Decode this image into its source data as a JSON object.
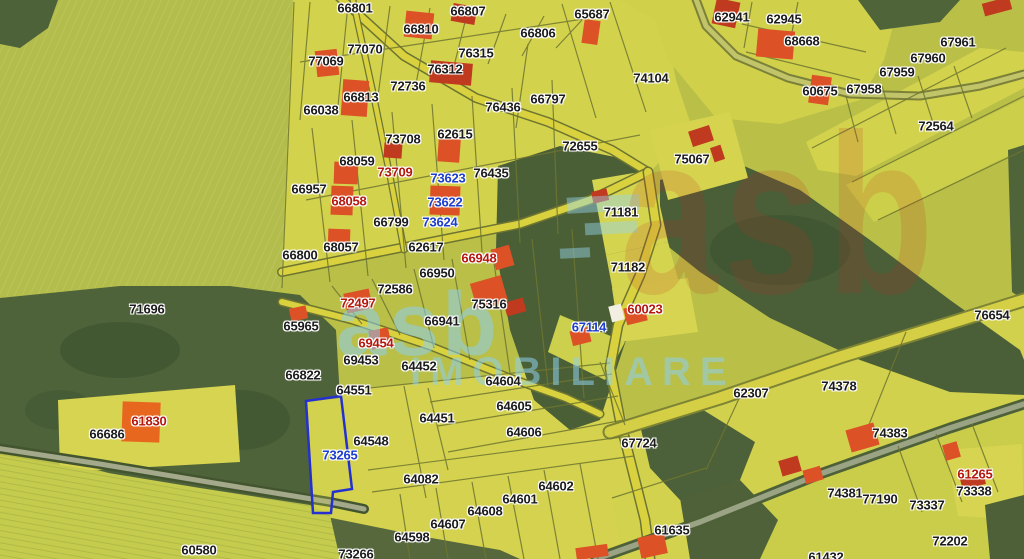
{
  "map": {
    "type": "cadastral-parcel-map",
    "selected_parcel": "73265",
    "watermark": {
      "brand": "asb",
      "word": "IMOBILIARE"
    },
    "colors": {
      "label_black": "#1b1b1b",
      "label_red": "#b5170e",
      "label_blue": "#1d3dcc",
      "selected_outline": "#2431d0",
      "watermark_blue": "rgba(142,208,236,0.55)",
      "watermark_red": "rgba(190,45,28,0.16)",
      "buildings": [
        "#dc5126",
        "#bf3a1f",
        "#e8671f",
        "#f2efe2"
      ]
    },
    "parcels": [
      {
        "id": "66801",
        "x": 355,
        "y": 8
      },
      {
        "id": "66807",
        "x": 468,
        "y": 11
      },
      {
        "id": "65687",
        "x": 592,
        "y": 14
      },
      {
        "id": "62941",
        "x": 732,
        "y": 17
      },
      {
        "id": "62945",
        "x": 784,
        "y": 19
      },
      {
        "id": "66810",
        "x": 421,
        "y": 29
      },
      {
        "id": "66806",
        "x": 538,
        "y": 33
      },
      {
        "id": "67961",
        "x": 958,
        "y": 42
      },
      {
        "id": "68668",
        "x": 802,
        "y": 41
      },
      {
        "id": "77070",
        "x": 365,
        "y": 49
      },
      {
        "id": "76315",
        "x": 476,
        "y": 53
      },
      {
        "id": "67960",
        "x": 928,
        "y": 58
      },
      {
        "id": "77069",
        "x": 326,
        "y": 61
      },
      {
        "id": "76312",
        "x": 445,
        "y": 69
      },
      {
        "id": "67959",
        "x": 897,
        "y": 72
      },
      {
        "id": "74104",
        "x": 651,
        "y": 78
      },
      {
        "id": "72736",
        "x": 408,
        "y": 86
      },
      {
        "id": "67958",
        "x": 864,
        "y": 89
      },
      {
        "id": "60675",
        "x": 820,
        "y": 91
      },
      {
        "id": "66813",
        "x": 361,
        "y": 97
      },
      {
        "id": "66797",
        "x": 548,
        "y": 99
      },
      {
        "id": "76436",
        "x": 503,
        "y": 107
      },
      {
        "id": "66038",
        "x": 321,
        "y": 110
      },
      {
        "id": "72564",
        "x": 936,
        "y": 126
      },
      {
        "id": "62615",
        "x": 455,
        "y": 134
      },
      {
        "id": "73708",
        "x": 403,
        "y": 139
      },
      {
        "id": "72655",
        "x": 580,
        "y": 146
      },
      {
        "id": "68059",
        "x": 357,
        "y": 161
      },
      {
        "id": "75067",
        "x": 692,
        "y": 159
      },
      {
        "id": "73709",
        "x": 395,
        "y": 172,
        "c": "r"
      },
      {
        "id": "76435",
        "x": 491,
        "y": 173
      },
      {
        "id": "73623",
        "x": 448,
        "y": 178,
        "c": "b"
      },
      {
        "id": "66957",
        "x": 309,
        "y": 189
      },
      {
        "id": "68058",
        "x": 349,
        "y": 201,
        "c": "r"
      },
      {
        "id": "73622",
        "x": 445,
        "y": 202,
        "c": "b"
      },
      {
        "id": "71181",
        "x": 621,
        "y": 212
      },
      {
        "id": "73624",
        "x": 440,
        "y": 222,
        "c": "b"
      },
      {
        "id": "66799",
        "x": 391,
        "y": 222
      },
      {
        "id": "68057",
        "x": 341,
        "y": 247
      },
      {
        "id": "62617",
        "x": 426,
        "y": 247
      },
      {
        "id": "66800",
        "x": 300,
        "y": 255
      },
      {
        "id": "66948",
        "x": 479,
        "y": 258,
        "c": "r"
      },
      {
        "id": "71182",
        "x": 628,
        "y": 267
      },
      {
        "id": "66950",
        "x": 437,
        "y": 273
      },
      {
        "id": "72586",
        "x": 395,
        "y": 289
      },
      {
        "id": "72497",
        "x": 358,
        "y": 303,
        "c": "r"
      },
      {
        "id": "75316",
        "x": 489,
        "y": 304
      },
      {
        "id": "71696",
        "x": 147,
        "y": 309
      },
      {
        "id": "60023",
        "x": 645,
        "y": 309,
        "c": "r"
      },
      {
        "id": "76654",
        "x": 992,
        "y": 315
      },
      {
        "id": "66941",
        "x": 442,
        "y": 321
      },
      {
        "id": "65965",
        "x": 301,
        "y": 326
      },
      {
        "id": "67114",
        "x": 589,
        "y": 327,
        "c": "b"
      },
      {
        "id": "69454",
        "x": 376,
        "y": 343,
        "c": "r"
      },
      {
        "id": "69453",
        "x": 361,
        "y": 360
      },
      {
        "id": "64452",
        "x": 419,
        "y": 366
      },
      {
        "id": "66822",
        "x": 303,
        "y": 375
      },
      {
        "id": "64604",
        "x": 503,
        "y": 381
      },
      {
        "id": "74378",
        "x": 839,
        "y": 386
      },
      {
        "id": "64551",
        "x": 354,
        "y": 390
      },
      {
        "id": "62307",
        "x": 751,
        "y": 393
      },
      {
        "id": "64605",
        "x": 514,
        "y": 406
      },
      {
        "id": "64451",
        "x": 437,
        "y": 418
      },
      {
        "id": "61830",
        "x": 149,
        "y": 421,
        "c": "r"
      },
      {
        "id": "64606",
        "x": 524,
        "y": 432
      },
      {
        "id": "66686",
        "x": 107,
        "y": 434
      },
      {
        "id": "74383",
        "x": 890,
        "y": 433
      },
      {
        "id": "64548",
        "x": 371,
        "y": 441
      },
      {
        "id": "67724",
        "x": 639,
        "y": 443
      },
      {
        "id": "73265",
        "x": 340,
        "y": 455,
        "c": "b"
      },
      {
        "id": "61265",
        "x": 975,
        "y": 474,
        "c": "r"
      },
      {
        "id": "64082",
        "x": 421,
        "y": 479
      },
      {
        "id": "64602",
        "x": 556,
        "y": 486
      },
      {
        "id": "73338",
        "x": 974,
        "y": 491
      },
      {
        "id": "74381",
        "x": 845,
        "y": 493
      },
      {
        "id": "64601",
        "x": 520,
        "y": 499
      },
      {
        "id": "77190",
        "x": 880,
        "y": 499
      },
      {
        "id": "73337",
        "x": 927,
        "y": 505
      },
      {
        "id": "64608",
        "x": 485,
        "y": 511
      },
      {
        "id": "64607",
        "x": 448,
        "y": 524
      },
      {
        "id": "61635",
        "x": 672,
        "y": 530
      },
      {
        "id": "64598",
        "x": 412,
        "y": 537
      },
      {
        "id": "72202",
        "x": 950,
        "y": 541
      },
      {
        "id": "60580",
        "x": 199,
        "y": 550
      },
      {
        "id": "73266",
        "x": 356,
        "y": 554
      },
      {
        "id": "61432",
        "x": 826,
        "y": 557
      }
    ],
    "buildings": [
      {
        "x": 405,
        "y": 12,
        "w": 28,
        "h": 26,
        "a": 6
      },
      {
        "x": 452,
        "y": 5,
        "w": 24,
        "h": 18,
        "a": 10,
        "f": 1
      },
      {
        "x": 583,
        "y": 20,
        "w": 16,
        "h": 24,
        "a": 8
      },
      {
        "x": 316,
        "y": 50,
        "w": 22,
        "h": 26,
        "a": -6
      },
      {
        "x": 714,
        "y": 0,
        "w": 24,
        "h": 26,
        "a": 12,
        "f": 1
      },
      {
        "x": 757,
        "y": 30,
        "w": 37,
        "h": 28,
        "a": 5
      },
      {
        "x": 810,
        "y": 76,
        "w": 20,
        "h": 28,
        "a": 8
      },
      {
        "x": 342,
        "y": 80,
        "w": 26,
        "h": 36,
        "a": 4
      },
      {
        "x": 430,
        "y": 62,
        "w": 42,
        "h": 22,
        "a": 5,
        "f": 1
      },
      {
        "x": 384,
        "y": 143,
        "w": 18,
        "h": 15,
        "a": 4,
        "f": 1
      },
      {
        "x": 438,
        "y": 139,
        "w": 22,
        "h": 23,
        "a": 4
      },
      {
        "x": 334,
        "y": 162,
        "w": 24,
        "h": 22,
        "a": 2
      },
      {
        "x": 331,
        "y": 186,
        "w": 22,
        "h": 29,
        "a": 2
      },
      {
        "x": 430,
        "y": 186,
        "w": 30,
        "h": 29,
        "a": 2
      },
      {
        "x": 328,
        "y": 229,
        "w": 22,
        "h": 23,
        "a": 2
      },
      {
        "x": 690,
        "y": 128,
        "w": 22,
        "h": 16,
        "a": -18,
        "f": 1
      },
      {
        "x": 712,
        "y": 146,
        "w": 11,
        "h": 15,
        "a": -18,
        "f": 1
      },
      {
        "x": 345,
        "y": 291,
        "w": 26,
        "h": 20,
        "a": -12
      },
      {
        "x": 290,
        "y": 307,
        "w": 17,
        "h": 13,
        "a": -12
      },
      {
        "x": 370,
        "y": 329,
        "w": 20,
        "h": 19,
        "a": -12
      },
      {
        "x": 493,
        "y": 247,
        "w": 19,
        "h": 21,
        "a": -16
      },
      {
        "x": 473,
        "y": 279,
        "w": 32,
        "h": 27,
        "a": -16
      },
      {
        "x": 505,
        "y": 300,
        "w": 20,
        "h": 14,
        "a": -16,
        "f": 1
      },
      {
        "x": 625,
        "y": 306,
        "w": 21,
        "h": 17,
        "a": -14
      },
      {
        "x": 610,
        "y": 305,
        "w": 13,
        "h": 16,
        "a": -14,
        "f": 3
      },
      {
        "x": 571,
        "y": 329,
        "w": 19,
        "h": 15,
        "a": -14
      },
      {
        "x": 592,
        "y": 190,
        "w": 16,
        "h": 12,
        "a": -14,
        "f": 1
      },
      {
        "x": 848,
        "y": 426,
        "w": 29,
        "h": 23,
        "a": -16
      },
      {
        "x": 944,
        "y": 443,
        "w": 15,
        "h": 16,
        "a": -16
      },
      {
        "x": 961,
        "y": 476,
        "w": 24,
        "h": 11,
        "a": -14,
        "f": 1
      },
      {
        "x": 122,
        "y": 402,
        "w": 38,
        "h": 40,
        "a": 2,
        "f": 2
      },
      {
        "x": 639,
        "y": 535,
        "w": 27,
        "h": 21,
        "a": -12
      },
      {
        "x": 576,
        "y": 546,
        "w": 32,
        "h": 12,
        "a": -8
      },
      {
        "x": 780,
        "y": 458,
        "w": 20,
        "h": 16,
        "a": -16,
        "f": 1
      },
      {
        "x": 804,
        "y": 468,
        "w": 18,
        "h": 14,
        "a": -16
      },
      {
        "x": 983,
        "y": 0,
        "w": 28,
        "h": 13,
        "a": -15,
        "f": 1
      }
    ]
  }
}
